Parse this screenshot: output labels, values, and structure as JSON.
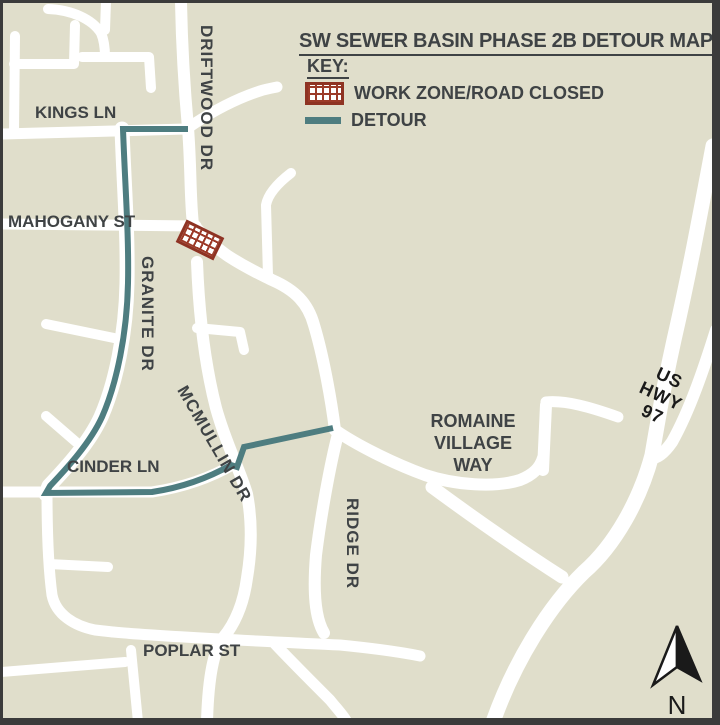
{
  "title": "SW SEWER BASIN PHASE 2B DETOUR MAP",
  "key": {
    "heading": "KEY:",
    "work_zone_label": "WORK ZONE/ROAD CLOSED",
    "detour_label": "DETOUR"
  },
  "streets": {
    "kings_ln": "KINGS LN",
    "driftwood_dr": "DRIFTWOOD DR",
    "mahogany_st": "MAHOGANY ST",
    "granite_dr": "GRANITE DR",
    "mcmullin_dr": "MCMULLIN DR",
    "cinder_ln": "CINDER LN",
    "ridge_dr": "RIDGE DR",
    "poplar_st": "POPLAR ST",
    "romaine_village_way": [
      "ROMAINE",
      "VILLAGE",
      "WAY"
    ],
    "us_hwy_97": [
      "US",
      "HWY",
      "97"
    ]
  },
  "compass": {
    "label": "N"
  },
  "colors": {
    "frame": "#3b3b3b",
    "background": "#e0decb",
    "road": "#ffffff",
    "detour": "#4e7d80",
    "work_zone_red": "#9c3a28",
    "work_zone_border": "#8e3323",
    "label_gray": "#3f4345",
    "label_black": "#1a1a1a"
  }
}
